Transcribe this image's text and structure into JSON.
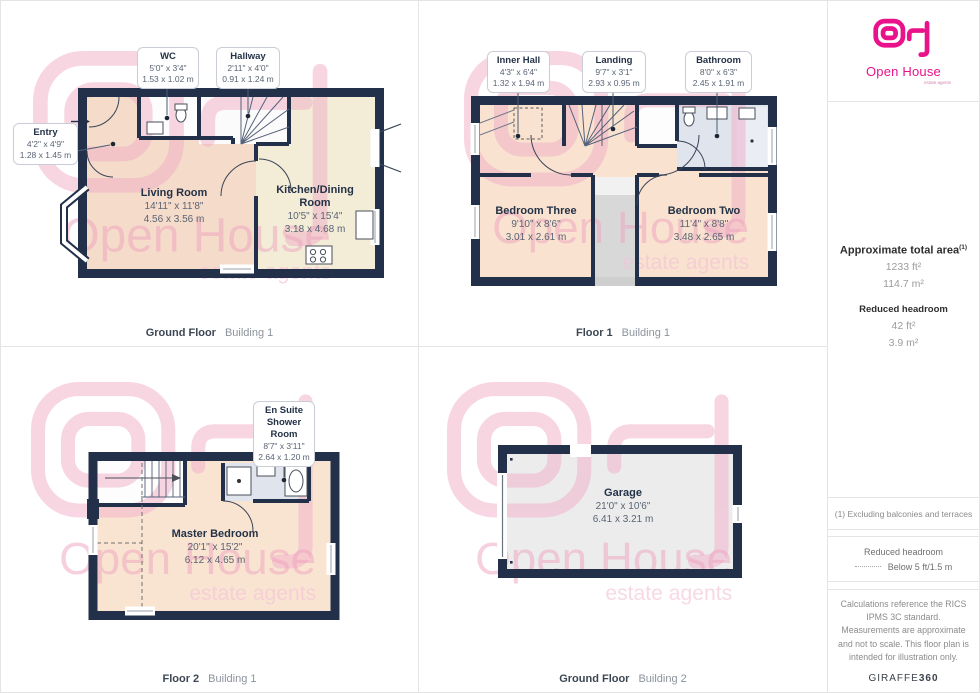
{
  "panels": [
    {
      "caption": {
        "floor": "Ground Floor",
        "building": "Building 1"
      },
      "callouts": [
        {
          "name": "WC",
          "imperial": "5'0\" x 3'4\"",
          "metric": "1.53 x 1.02 m"
        },
        {
          "name": "Hallway",
          "imperial": "2'11\" x 4'0\"",
          "metric": "0.91 x 1.24 m"
        },
        {
          "name": "Entry",
          "imperial": "4'2\" x 4'9\"",
          "metric": "1.28 x 1.45 m"
        }
      ],
      "rooms": [
        {
          "name": "Living Room",
          "imperial": "14'11\" x 11'8\"",
          "metric": "4.56 x 3.56 m"
        },
        {
          "name": "Kitchen/Dining Room",
          "imperial": "10'5\" x 15'4\"",
          "metric": "3.18 x 4.68 m"
        }
      ]
    },
    {
      "caption": {
        "floor": "Floor 1",
        "building": "Building 1"
      },
      "callouts": [
        {
          "name": "Inner Hall",
          "imperial": "4'3\" x 6'4\"",
          "metric": "1.32 x 1.94 m"
        },
        {
          "name": "Landing",
          "imperial": "9'7\" x 3'1\"",
          "metric": "2.93 x 0.95 m"
        },
        {
          "name": "Bathroom",
          "imperial": "8'0\" x 6'3\"",
          "metric": "2.45 x 1.91 m"
        }
      ],
      "rooms": [
        {
          "name": "Bedroom Three",
          "imperial": "9'10\" x 8'6\"",
          "metric": "3.01 x 2.61 m"
        },
        {
          "name": "Bedroom Two",
          "imperial": "11'4\" x 8'8\"",
          "metric": "3.48 x 2.65 m"
        }
      ]
    },
    {
      "caption": {
        "floor": "Floor 2",
        "building": "Building 1"
      },
      "callouts": [
        {
          "name": "En Suite Shower Room",
          "imperial": "8'7\" x 3'11\"",
          "metric": "2.64 x 1.20 m"
        }
      ],
      "rooms": [
        {
          "name": "Master Bedroom",
          "imperial": "20'1\" x 15'2\"",
          "metric": "6.12 x 4.65 m"
        }
      ]
    },
    {
      "caption": {
        "floor": "Ground Floor",
        "building": "Building 2"
      },
      "rooms": [
        {
          "name": "Garage",
          "imperial": "21'0\" x 10'6\"",
          "metric": "6.41 x 3.21 m"
        }
      ]
    }
  ],
  "watermark": {
    "line1": "Open House",
    "line2": "estate agents"
  },
  "sidebar": {
    "logo": {
      "brand": "Open House",
      "tagline": "estate agents"
    },
    "area": {
      "title": "Approximate total area",
      "title_sup": "(1)",
      "value_ft": "1233 ft²",
      "value_m": "114.7 m²",
      "reduced_title": "Reduced headroom",
      "reduced_ft": "42 ft²",
      "reduced_m": "3.9 m²"
    },
    "footnote": "(1) Excluding balconies and terraces",
    "legend": {
      "title": "Reduced headroom",
      "item": "Below 5 ft/1.5 m"
    },
    "disclaimer": "Calculations reference the RICS IPMS 3C standard. Measurements are approximate and not to scale. This floor plan is intended for illustration only.",
    "brand_footer": {
      "name": "GIRAFFE",
      "suffix": "360"
    }
  },
  "colors": {
    "wall": "#22304a",
    "peach": "#f5dbc9",
    "peach_light": "#f9e3d0",
    "cream": "#f3ecd7",
    "bath_blue": "#dfe4ed",
    "garage_gray": "#ececec",
    "brand_pink": "#e9128b",
    "watermark_pink": "#f1aec7"
  }
}
